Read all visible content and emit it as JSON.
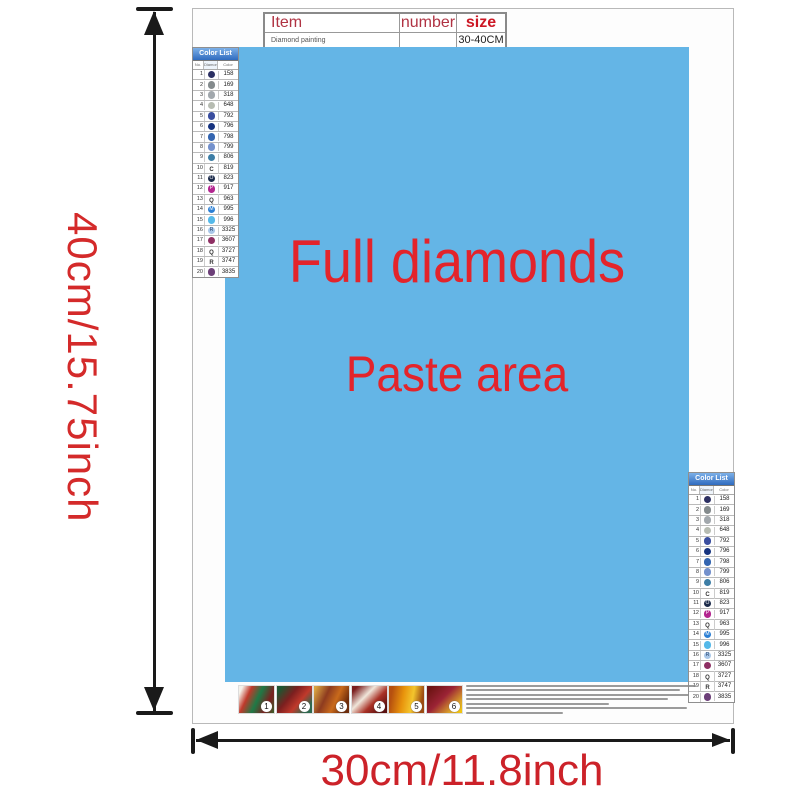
{
  "dims": {
    "height_label": "40cm/15.75inch",
    "width_label": "30cm/11.8inch"
  },
  "info_table": {
    "headers": [
      "Item",
      "number",
      "size"
    ],
    "row": [
      "Diamond painting",
      "",
      "30-40CM"
    ]
  },
  "paste_area": {
    "line1": "Full diamonds",
    "line2": "Paste area",
    "bg_color": "#64b5e6",
    "text_color": "#e3242b"
  },
  "color_list": {
    "title": "Color List",
    "columns": [
      "No.",
      "Diamond",
      "Color"
    ],
    "rows": [
      {
        "no": 1,
        "glyph": "",
        "dot": "#2c3063",
        "code": "158"
      },
      {
        "no": 2,
        "glyph": "",
        "dot": "#848b8d",
        "code": "169"
      },
      {
        "no": 3,
        "glyph": "",
        "dot": "#a2a8ad",
        "code": "318"
      },
      {
        "no": 4,
        "glyph": "",
        "dot": "#b7bcb2",
        "code": "648"
      },
      {
        "no": 5,
        "glyph": "",
        "dot": "#3a4e9f",
        "code": "792"
      },
      {
        "no": 6,
        "glyph": "",
        "dot": "#16337f",
        "code": "796"
      },
      {
        "no": 7,
        "glyph": "",
        "dot": "#3465b0",
        "code": "798"
      },
      {
        "no": 8,
        "glyph": "",
        "dot": "#7491cc",
        "code": "799"
      },
      {
        "no": 9,
        "glyph": "",
        "dot": "#3d7ea6",
        "code": "806"
      },
      {
        "no": 10,
        "glyph": "C",
        "dot": null,
        "code": "819"
      },
      {
        "no": 11,
        "glyph": "O",
        "dot": "#1b2a4a",
        "code": "823"
      },
      {
        "no": 12,
        "glyph": "P",
        "dot": "#b3258f",
        "code": "917"
      },
      {
        "no": 13,
        "glyph": "Q",
        "dot": null,
        "code": "963"
      },
      {
        "no": 14,
        "glyph": "M",
        "dot": "#2b7fd4",
        "code": "995"
      },
      {
        "no": 15,
        "glyph": "",
        "dot": "#55b9e9",
        "code": "996"
      },
      {
        "no": 16,
        "glyph": "R",
        "dot": "#a9c7e8",
        "code": "3325",
        "glyph_color": "#23406b"
      },
      {
        "no": 17,
        "glyph": "",
        "dot": "#8e2f63",
        "code": "3607"
      },
      {
        "no": 18,
        "glyph": "Q",
        "dot": null,
        "code": "3727"
      },
      {
        "no": 19,
        "glyph": "R",
        "dot": null,
        "code": "3747"
      },
      {
        "no": 20,
        "glyph": "",
        "dot": "#6d4079",
        "code": "3835"
      }
    ]
  },
  "steps": {
    "numbers": [
      "1",
      "2",
      "3",
      "4",
      "5",
      "6"
    ]
  },
  "colors": {
    "dimension_red": "#cc2229",
    "arrow_black": "#1a1a1a",
    "list_header_blue": "#2f6bbf",
    "table_header_red": "#b03343",
    "table_size_red": "#cc1724"
  }
}
